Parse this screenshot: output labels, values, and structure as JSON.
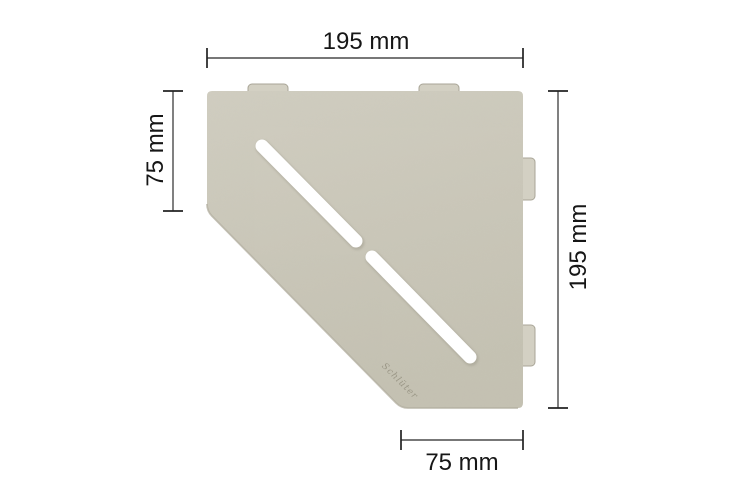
{
  "title": "Pentagonal corner shelf dimension diagram",
  "shelf": {
    "shape": "pentagonal corner shelf with diagonal slot",
    "engraving": "Schlüter",
    "colors": {
      "plate": "#cac7b9",
      "plate_light": "#d1cec1",
      "plate_dark": "#c5c2b3",
      "tab": "#d3d0c3",
      "tab_edge": "#a9a597",
      "edge_shade": "#b2ae9f",
      "slot": "#ffffff"
    }
  },
  "dimensions": {
    "top": {
      "label": "195 mm"
    },
    "right": {
      "label": "195 mm"
    },
    "left": {
      "label": "75 mm"
    },
    "bottom": {
      "label": "75 mm"
    }
  },
  "style": {
    "background": "#ffffff",
    "line_color": "#4a4a4a",
    "tick_color": "#222222",
    "text_color": "#161616"
  }
}
